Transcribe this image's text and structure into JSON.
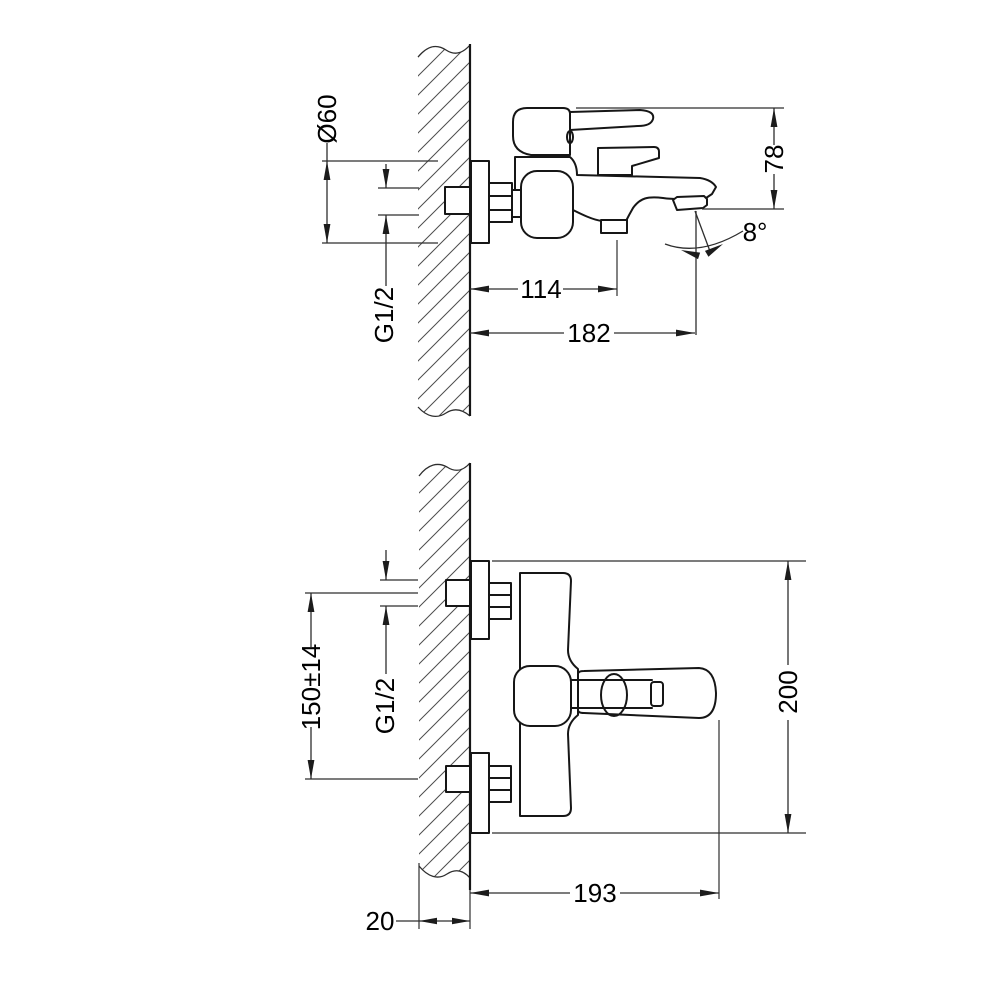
{
  "drawing_title": "Wall-mounted bath mixer — dimensional drawing, two views",
  "side_view": {
    "dims": {
      "escutcheon_diameter": "Ø60",
      "connection_thread": "G1/2",
      "spout_drop_height": "78",
      "spout_angle": "8°",
      "shower_outlet_offset": "114",
      "spout_reach": "182"
    }
  },
  "front_view": {
    "dims": {
      "connection_centers": "150±14",
      "connection_thread": "G1/2",
      "overall_height": "200",
      "overall_width": "193",
      "wall_section": "20"
    }
  },
  "colors": {
    "background": "#ffffff",
    "outline": "#161616",
    "dimension_lines": "#2e2e2e",
    "hatching": "#4d4d4d"
  }
}
